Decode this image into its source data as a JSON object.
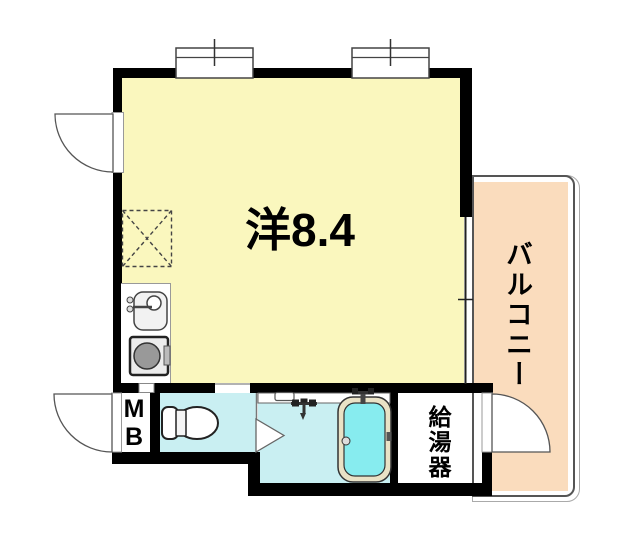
{
  "labels": {
    "main_room": "洋8.4",
    "balcony": "バルコニー",
    "meter_box": "MB",
    "water_heater": "給湯器"
  },
  "rooms": [
    {
      "name": "main-room",
      "label": "洋8.4",
      "type": "western-style room",
      "size_tatami": 8.4,
      "fill": "#FAF7BE"
    },
    {
      "name": "balcony",
      "label": "バルコニー",
      "fill": "#FADCBD"
    },
    {
      "name": "toilet-room",
      "label": "",
      "fill": "#C9EFF2"
    },
    {
      "name": "bathroom",
      "label": "",
      "fill": "#C9EFF2"
    },
    {
      "name": "meter-box",
      "label": "MB",
      "fill": "#FFFFFF"
    },
    {
      "name": "water-heater-room",
      "label": "給湯器",
      "fill": "#FFFFFF"
    }
  ],
  "icons": {
    "kitchen_sink": "sink with faucet",
    "stove": "single burner / washer box",
    "refrigerator_space": "dashed box with X",
    "toilet": "toilet bowl with tank",
    "bathtub": "bathtub with water",
    "bath_faucet": "wall mixer faucet",
    "tub_faucet": "tub mixer faucet",
    "windows": 2,
    "door_arcs": 3,
    "bath_door": "triangle door marker"
  },
  "colors": {
    "wall": "#000000",
    "main_room_fill": "#FAF7BE",
    "balcony_fill": "#FADCBD",
    "wet_area_fill": "#C9EFF2",
    "tub_water": "#87ECEF",
    "tub_rim": "#E9E2C6",
    "thin_line": "#555555",
    "background": "#FFFFFF"
  }
}
